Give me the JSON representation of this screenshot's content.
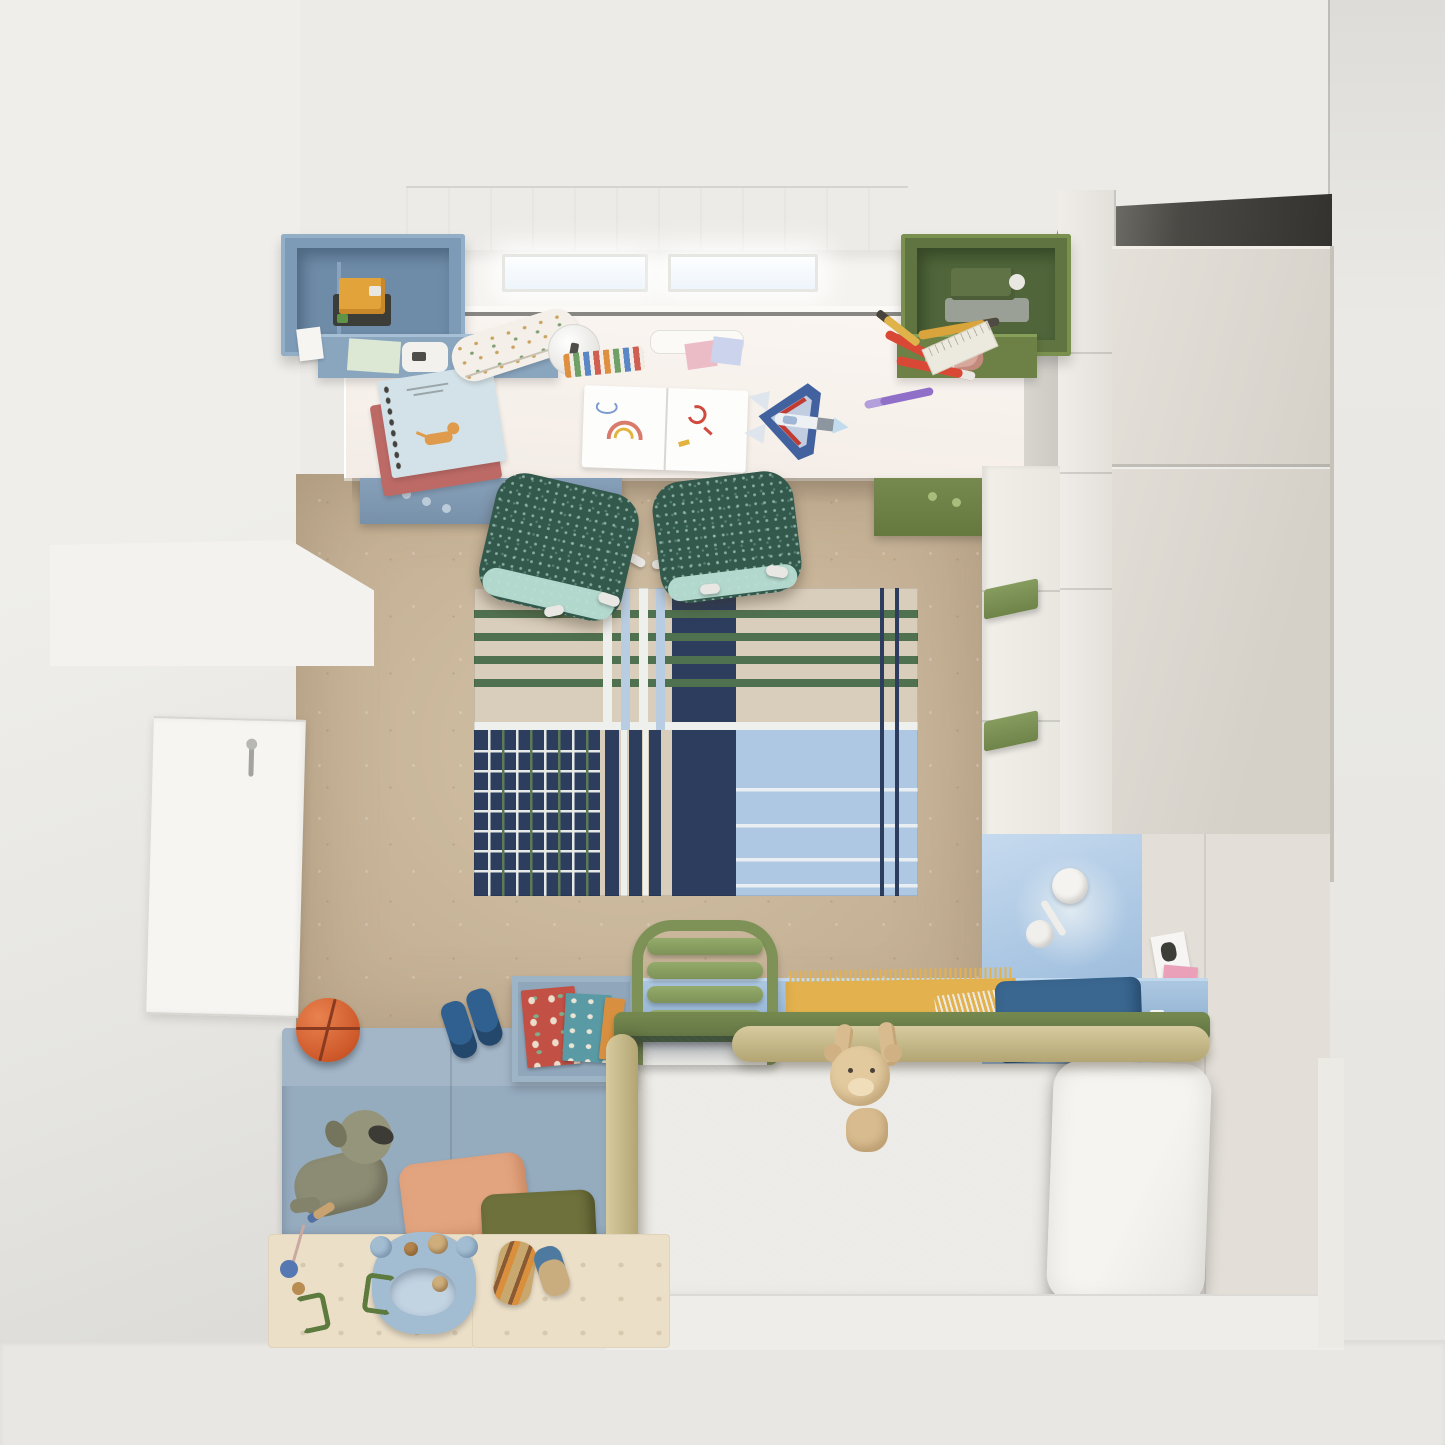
{
  "scene": {
    "description": "Top-down 3D render of a children's bedroom with desk under a window, plaid rug, wardrobe, single bed with safety rails, upholstered bench and play mats",
    "view": "bird's-eye / plan view",
    "visible_text": "none"
  },
  "palette": {
    "wall": "#ecebe7",
    "wall_shadow": "#33322e",
    "floor_concrete": "#c7b499",
    "floor_white": "#e8e7e3",
    "desk_top": "#f8f2ee",
    "unit_blue": "#7d9ab6",
    "unit_green": "#5f7440",
    "rug_beige": "#d9cdbb",
    "rug_navy": "#2d3d5d",
    "rug_green": "#507150",
    "rug_light_blue": "#aec7e2",
    "chair_teal": "#33594d",
    "chair_mint": "#b9ded3",
    "bed_blue": "#31618e",
    "headboard_blue": "#a7c4e1",
    "rail_olive": "#75894f",
    "rail_beige": "#c8ba8e",
    "blanket_yellow": "#e3b24e",
    "bench_blue": "#95abbe",
    "mat_cream": "#ebdfc8",
    "basketball_orange": "#cf5a2b",
    "wardrobe_cream": "#dcd8d1"
  },
  "objects": {
    "scene_desc": "kids bedroom seen from above",
    "wall_left": "left wall",
    "wall_right": "right wall",
    "wall_bedhead": "wall panel behind bed head",
    "wall_gap": "shadowed wall strip beside desk",
    "ledge": "low wall ledge",
    "door": "room door seen from above",
    "door_handle": "door handle",
    "floor": "concrete floor",
    "floor_band": "light floor strip at room edge",
    "curtain": "sheer roman curtain",
    "window_pane": "window pane with daylight",
    "window_sill": "window sill",
    "desk": "long white desk top",
    "desk_seam": "desk back edge seam",
    "desk_shadow": "shadow under desk",
    "drawer_blue": "blue under-desk drawer unit",
    "drawer_green": "green under-desk drawer unit",
    "shelf_blue": "wall-hung blue storage cubes",
    "lego_toy": "LEGO robot toy",
    "paper_mint": "mint note paper",
    "tape_dispenser": "tape dispenser",
    "card_white": "small white card",
    "shelf_green": "wall-hung green storage cubes",
    "sewing_toy": "toy sewing machine",
    "plush_pink": "small pink plush",
    "pencil_yellow": "yellow pencil",
    "notebook_red": "rose notebook",
    "notebook_blue": "spiral notebook with cat drawing",
    "cat_doodle": "cat drawing",
    "sketchbook": "open sketchbook with doodles",
    "pencil_case": "patterned pencil case",
    "pencil_cup": "round white sharpener",
    "tray": "white pen tray",
    "sticky_notes": "sticky notes",
    "crayons": "crayons",
    "lego_plane": "LEGO jet airplane",
    "marker_red": "red felt-tip pen",
    "pen_purple": "purple pen",
    "ruler": "ruler",
    "pencil": "pencil",
    "chair": "teal swivel desk chair",
    "caster": "chair caster",
    "rug": "plaid area rug in navy, green and light blue",
    "wardrobe_shadow": "shadow gap above wardrobe",
    "wardrobe_top": "wardrobe top seen from above",
    "cabinet_column": "tall cabinet column",
    "drawer_column": "drawer column with green handles",
    "drawer_handle": "green drawer handle",
    "headboard": "light blue headboard panel",
    "lamp": "white articulated wall lamp",
    "lamp_glow": "lamp light glow",
    "bedframe": "light blue bed frame rail",
    "book_box": "blue picture-book box",
    "book": "picture book",
    "ladder": "green bed ladder",
    "blanket_yellow": "yellow fringed blanket",
    "fringe_white": "blanket fringe",
    "pillow_blue": "dark blue cushion",
    "rail_green": "olive bed rail",
    "duvet": "blue duvet",
    "pillow_white": "white pillow",
    "rail_beige": "upholstered safety rail",
    "teddy": "plush teddy hanging over rail",
    "platform": "white bed platform",
    "sticker": "postcard on wall",
    "bench": "upholstered blue bench",
    "dog": "plush dog",
    "pillow_salmon": "salmon cushion",
    "pillow_olive": "olive cushion",
    "play_mat": "perforated play mat",
    "hippo": "hippo-shaped activity board",
    "toy_roller": "wooden roller toy",
    "toy_mini": "small wooden toy",
    "pull_toy": "wooden pull toy with beads",
    "basketball": "basketball",
    "boots": "blue rain boots"
  }
}
